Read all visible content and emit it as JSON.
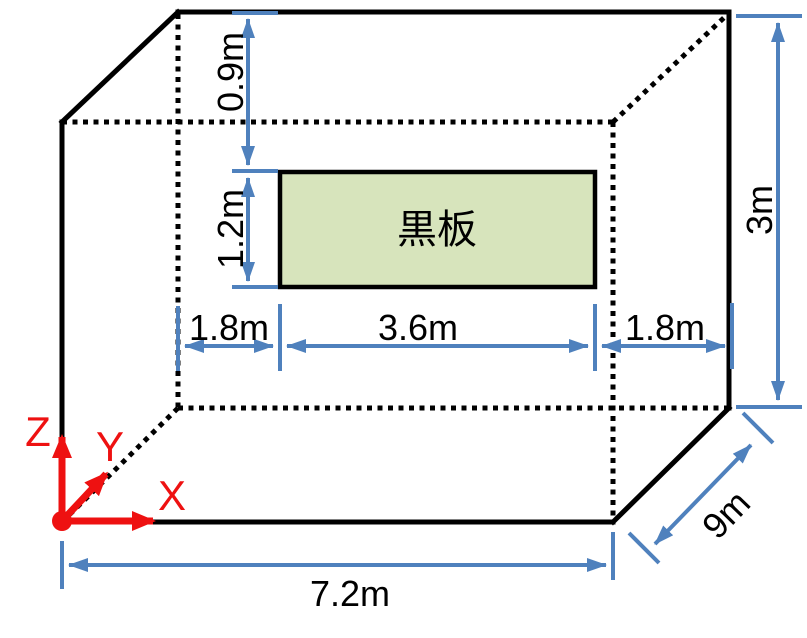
{
  "title": "Classroom 3D dimension diagram with blackboard",
  "colors": {
    "bg": "#ffffff",
    "edge": "#000000",
    "ink": "#000000",
    "dim": "#4f81bd",
    "axis": "#ee1111",
    "board_fill": "#d7e4bc"
  },
  "board": {
    "label": "黒板"
  },
  "dims": {
    "ceiling_gap": "0.9m",
    "board_height": "1.2m",
    "wall_height": "3m",
    "left_gap": "1.8m",
    "board_width": "3.6m",
    "right_gap": "1.8m",
    "floor_width": "7.2m",
    "room_depth": "9m"
  },
  "axes": {
    "x": "X",
    "y": "Y",
    "z": "Z"
  }
}
